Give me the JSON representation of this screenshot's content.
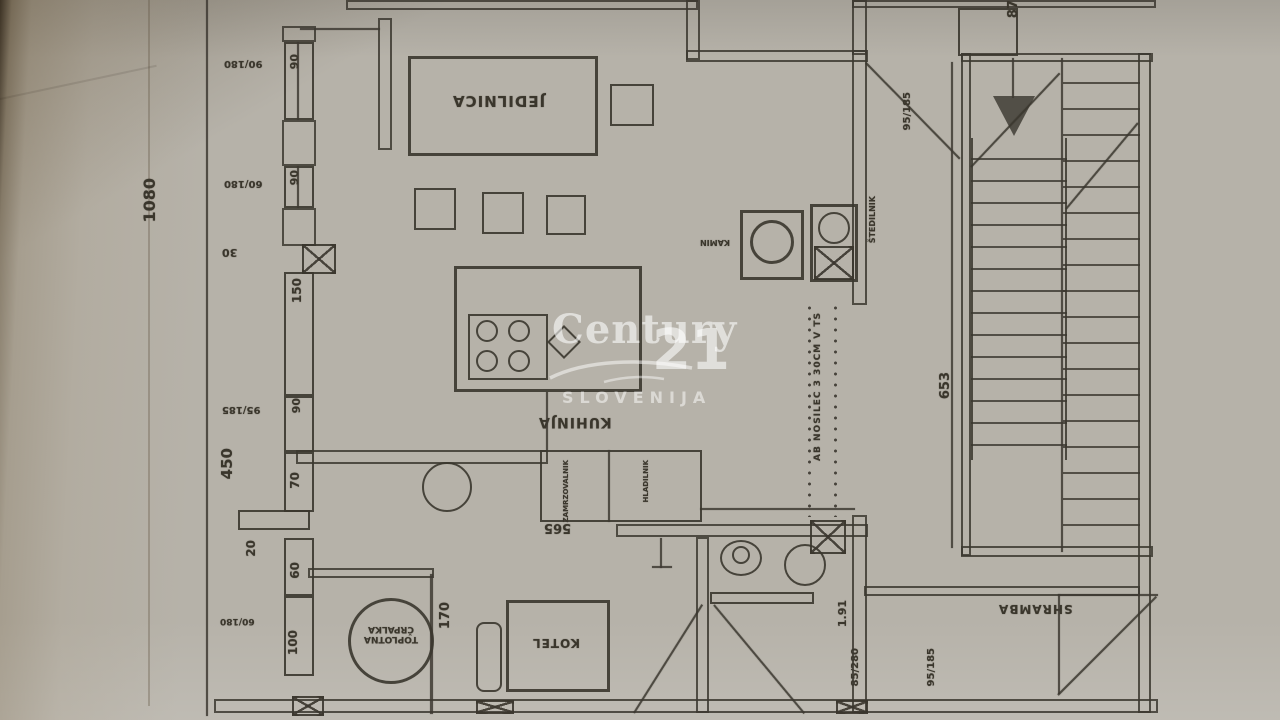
{
  "watermark": {
    "brand": "Century",
    "number": "21",
    "region": "SLOVENIJA"
  },
  "labels": {
    "dining": "JEDILNICA",
    "kitchen": "KUHINJA",
    "boiler": "KOTEL",
    "heat_pump_l1": "TOPLOTNA",
    "heat_pump_l2": "ČRPALKA",
    "pantry": "SHRAMBA",
    "fireplace": "KAMIN",
    "stove": "ŠTEDILNIK",
    "freezer": "ZAMRZOVALNIK",
    "fridge": "HLADILNIK"
  },
  "dims": {
    "overall": "1080",
    "d450": "450",
    "d150": "150",
    "d30": "30",
    "d90": "90",
    "d70": "70",
    "d20": "20",
    "d60": "60",
    "d100": "100",
    "d170": "170",
    "d565": "565",
    "d653": "653",
    "d87": "87",
    "d191": "1.91",
    "d85_280": "85/280",
    "w90_180": "90/180",
    "w60_180": "60/180",
    "d95_185": "95/185"
  },
  "notes": {
    "beam": "AB NOSILEC 3 30CM V TS"
  },
  "colors": {
    "paper": "#b6b2a9",
    "ink": "#3a362c",
    "shadow": "#574a36",
    "watermark": "#ffffff"
  }
}
